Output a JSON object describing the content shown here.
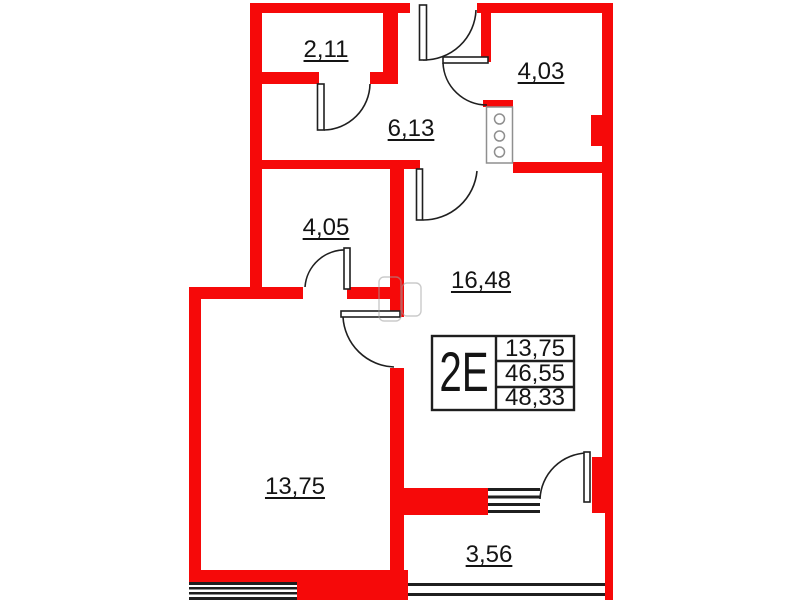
{
  "plan_type": "apartment-floor-plan",
  "rooms": [
    {
      "name": "closet",
      "area": "2,11"
    },
    {
      "name": "bathroom",
      "area": "4,03"
    },
    {
      "name": "hallway",
      "area": "6,13"
    },
    {
      "name": "storeroom",
      "area": "4,05"
    },
    {
      "name": "kitchen-living-room",
      "area": "16,48"
    },
    {
      "name": "bedroom",
      "area": "13,75"
    },
    {
      "name": "balcony",
      "area": "3,56"
    }
  ],
  "info_table": {
    "type_label": "2E",
    "row1": "13,75",
    "row2": "46,55",
    "row3": "48,33"
  },
  "colors": {
    "wall_red": "#f60909",
    "line_dark": "#1f1f1f",
    "shaft_gray": "#8f8f8f",
    "fixture_gray": "#a0a0a0"
  }
}
